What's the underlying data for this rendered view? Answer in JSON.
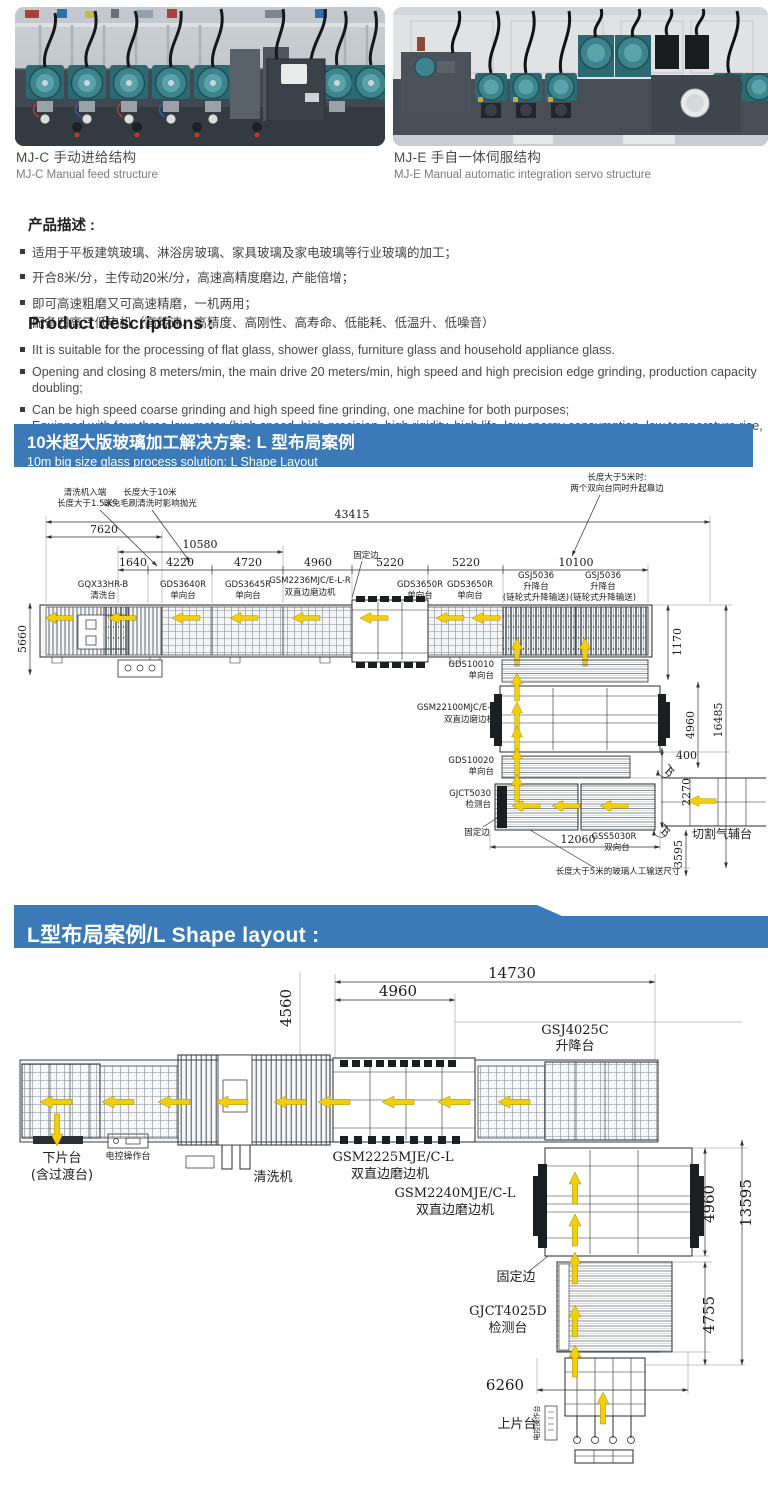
{
  "photos": {
    "left": {
      "caption_zh": "MJ-C 手动进给结构",
      "caption_en": "MJ-C Manual feed structure"
    },
    "right": {
      "caption_zh": "MJ-E 手自一体伺服结构",
      "caption_en": "MJ-E Manual automatic  integration servo structure"
    }
  },
  "desc_zh": {
    "heading": "产品描述 :",
    "b1": "适用于平板建筑玻璃、淋浴房玻璃、家具玻璃及家电玻璃等行业玻璃的加工；",
    "b2": "开合8米/分，主传动20米/分，高速高精度磨边, 产能倍增；",
    "b3": "即可高速粗磨又可高速精磨，一机两用；",
    "b4": "配备四高三低电机（高转速、高精度、高刚性、高寿命、低能耗、低温升、低噪音）"
  },
  "desc_en": {
    "heading": "Product descriptions :",
    "b1": "IIt is suitable for the processing of flat glass, shower glass, furniture glass and household appliance glass.",
    "b2": "Opening and closing 8 meters/min, the main drive 20 meters/min, high speed and high precision edge grinding, production capacity doubling;",
    "b3": "Can be high speed coarse grinding and high speed fine grinding, one machine for both purposes;",
    "b4": "Equipped with four three low motor (high speed, high precision, high rigidity, high life, low energy consumption, low temperature rise, low noise)"
  },
  "banner1": {
    "line1": "10米超大版玻璃加工解决方案: L 型布局案例",
    "line2": "10m big size glass process solution: L Shape Layout"
  },
  "banner2": {
    "title": "L型布局案例/L Shape layout :"
  },
  "colors": {
    "banner_bg": "#3b7ab7",
    "arrow_yellow": "#f2cf0a"
  },
  "d1": {
    "callout_wash1": "清洗机入端",
    "callout_wash2": "长度大于1.5米",
    "callout_len1": "长度大于10米",
    "callout_len2": "以免毛刷清洗时影响抛光",
    "callout_5m1": "长度大于5米时:",
    "callout_5m2": "两个双向台同时升起靠边",
    "fixed_top": "固定边",
    "fixed_bottom": "固定边",
    "dim_total": "43415",
    "dim_7620": "7620",
    "dim_10580": "10580",
    "seg1": "1640",
    "seg2": "4220",
    "seg3": "4720",
    "seg4": "4960",
    "seg5": "5220",
    "seg6": "5220",
    "seg7": "10100",
    "dim_5660": "5660",
    "dim_1170": "1170",
    "dim_4960": "4960",
    "dim_16485": "16485",
    "dim_400": "400",
    "dim_2270": "2270",
    "dim_3595": "3595",
    "dim_12060": "12060",
    "mc_wash1": "GQX33HR-B",
    "mc_wash2": "清洗台",
    "mc_3640_1": "GDS3640R",
    "mc_3640_2": "单向台",
    "mc_3645_1": "GDS3645R",
    "mc_3645_2": "单向台",
    "mc_2236_1": "GSM2236MJC/E-L-R",
    "mc_2236_2": "双直边磨边机",
    "mc_3650a1": "GDS3650R",
    "mc_3650a2": "单向台",
    "mc_3650b1": "GDS3650R",
    "mc_3650b2": "单向台",
    "mc_gsja1": "GSJ5036",
    "mc_gsja2": "升降台",
    "mc_gsja3": "(链轮式升降输送)",
    "mc_gsjb1": "GSJ5036",
    "mc_gsjb2": "升降台",
    "mc_gsjb3": "(链轮式升降输送)",
    "mc_10010_1": "GDS10010",
    "mc_10010_2": "单向台",
    "mc_22100_1": "GSM22100MJC/E-L",
    "mc_22100_2": "双直边磨边机",
    "mc_10020_1": "GDS10020",
    "mc_10020_2": "单向台",
    "mc_5030_1": "GJCT5030",
    "mc_5030_2": "检测台",
    "mc_gss1": "GSS5030R",
    "mc_gss2": "双向台",
    "cutting": "切割气辅台",
    "manual": "长度大于5米的玻璃人工输送尺寸",
    "e1": "E",
    "e2": "E"
  },
  "d2": {
    "dim_14730": "14730",
    "dim_4560": "4560",
    "dim_4960t": "4960",
    "dim_4960r": "4960",
    "dim_13595": "13595",
    "dim_4755": "4755",
    "dim_6260": "6260",
    "gsj1": "GSJ4025C",
    "gsj2": "升降台",
    "unload1": "下片台",
    "unload2": "(含过渡台)",
    "console1": "电控操作台",
    "washer": "清洗机",
    "m2225_1": "GSM2225MJE/C-L",
    "m2225_2": "双直边磨边机",
    "m2240_1": "GSM2240MJE/C-L",
    "m2240_2": "双直边磨边机",
    "fixed": "固定边",
    "gjct1": "GJCT4025D",
    "gjct2": "检测台",
    "load": "上片台",
    "console2": "电控操作台"
  }
}
